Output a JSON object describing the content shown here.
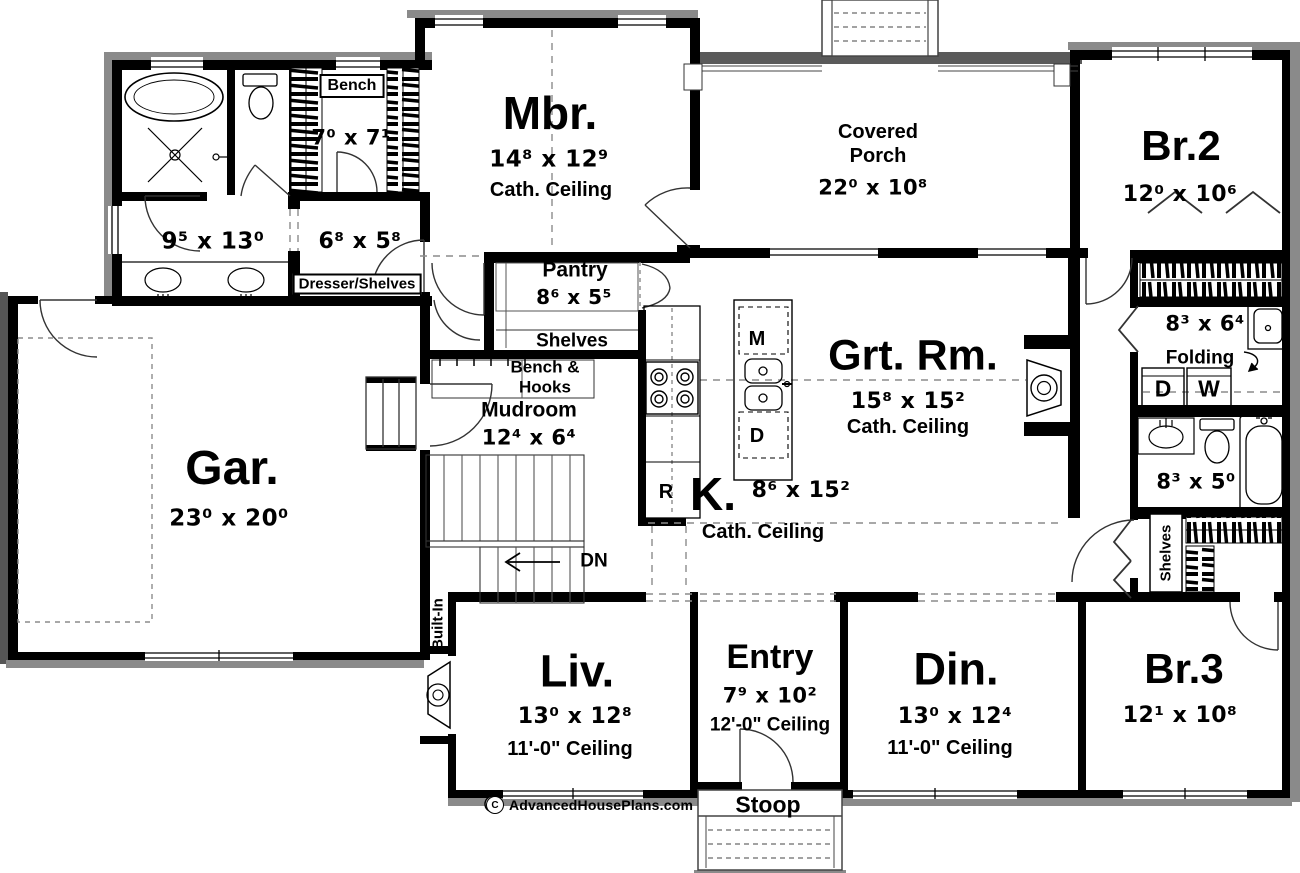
{
  "meta": {
    "title": "First floor plan",
    "background": "#ffffff",
    "wall_color": "#000000",
    "shadow_color": "#8a8a8a"
  },
  "rooms": {
    "master_bedroom": {
      "name": "Mbr.",
      "dim": "14⁸ x 12⁹",
      "ceiling": "Cath. Ceiling"
    },
    "covered_porch": {
      "name_line1": "Covered",
      "name_line2": "Porch",
      "dim": "22⁰ x 10⁸"
    },
    "bedroom2": {
      "name": "Br.2",
      "dim": "12⁰ x 10⁶"
    },
    "bedroom3": {
      "name": "Br.3",
      "dim": "12¹ x 10⁸"
    },
    "great_room": {
      "name": "Grt. Rm.",
      "dim": "15⁸ x 15²",
      "ceiling": "Cath. Ceiling"
    },
    "kitchen": {
      "name": "K.",
      "dim": "8⁶ x 15²",
      "ceiling": "Cath. Ceiling"
    },
    "living": {
      "name": "Liv.",
      "dim": "13⁰ x 12⁸",
      "ceiling": "11'-0\" Ceiling"
    },
    "dining": {
      "name": "Din.",
      "dim": "13⁰ x 12⁴",
      "ceiling": "11'-0\" Ceiling"
    },
    "entry": {
      "name": "Entry",
      "dim": "7⁹ x 10²",
      "ceiling": "12'-0\" Ceiling"
    },
    "garage": {
      "name": "Gar.",
      "dim": "23⁰ x 20⁰"
    },
    "mudroom": {
      "name": "Mudroom",
      "dim": "12⁴ x 6⁴"
    },
    "pantry": {
      "name": "Pantry",
      "dim": "8⁶ x 5⁵"
    },
    "master_bath": {
      "dim": "9⁵ x 13⁰"
    },
    "master_closet": {
      "dim": "6⁸ x 5⁸",
      "note": "Dresser/Shelves"
    },
    "bench_closet": {
      "label": "Bench",
      "dim": "7⁰ x 7¹"
    },
    "laundry": {
      "dim": "8³ x 6⁴",
      "folding_label": "Folding",
      "dryer_label": "D",
      "washer_label": "W"
    },
    "bath2": {
      "dim": "8³ x 5⁰"
    },
    "stoop": {
      "name": "Stoop"
    }
  },
  "labels": {
    "shelves_pantry": "Shelves",
    "bench_hooks_line1": "Bench &",
    "bench_hooks_line2": "Hooks",
    "stairs_down": "DN",
    "built_in": "Built-In",
    "shelves_closet": "Shelves",
    "island_microwave": "M",
    "island_dishwasher": "D",
    "refrigerator": "R"
  },
  "branding": {
    "copyright": "C",
    "site": "AdvancedHousePlans.com"
  }
}
